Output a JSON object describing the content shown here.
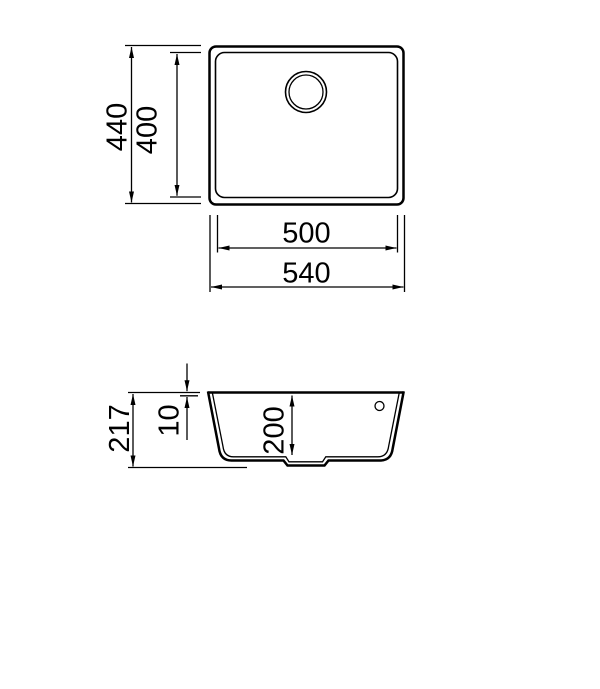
{
  "colors": {
    "line": "#000000",
    "background": "#ffffff"
  },
  "top_view": {
    "overall_depth": {
      "value": 440,
      "label": "440"
    },
    "bowl_depth": {
      "value": 400,
      "label": "400"
    },
    "bowl_width": {
      "value": 500,
      "label": "500"
    },
    "overall_width": {
      "value": 540,
      "label": "540"
    }
  },
  "section_view": {
    "total_height": {
      "value": 217,
      "label": "217"
    },
    "rim_thickness": {
      "value": 10,
      "label": "10"
    },
    "bowl_inner_depth": {
      "value": 200,
      "label": "200"
    }
  }
}
